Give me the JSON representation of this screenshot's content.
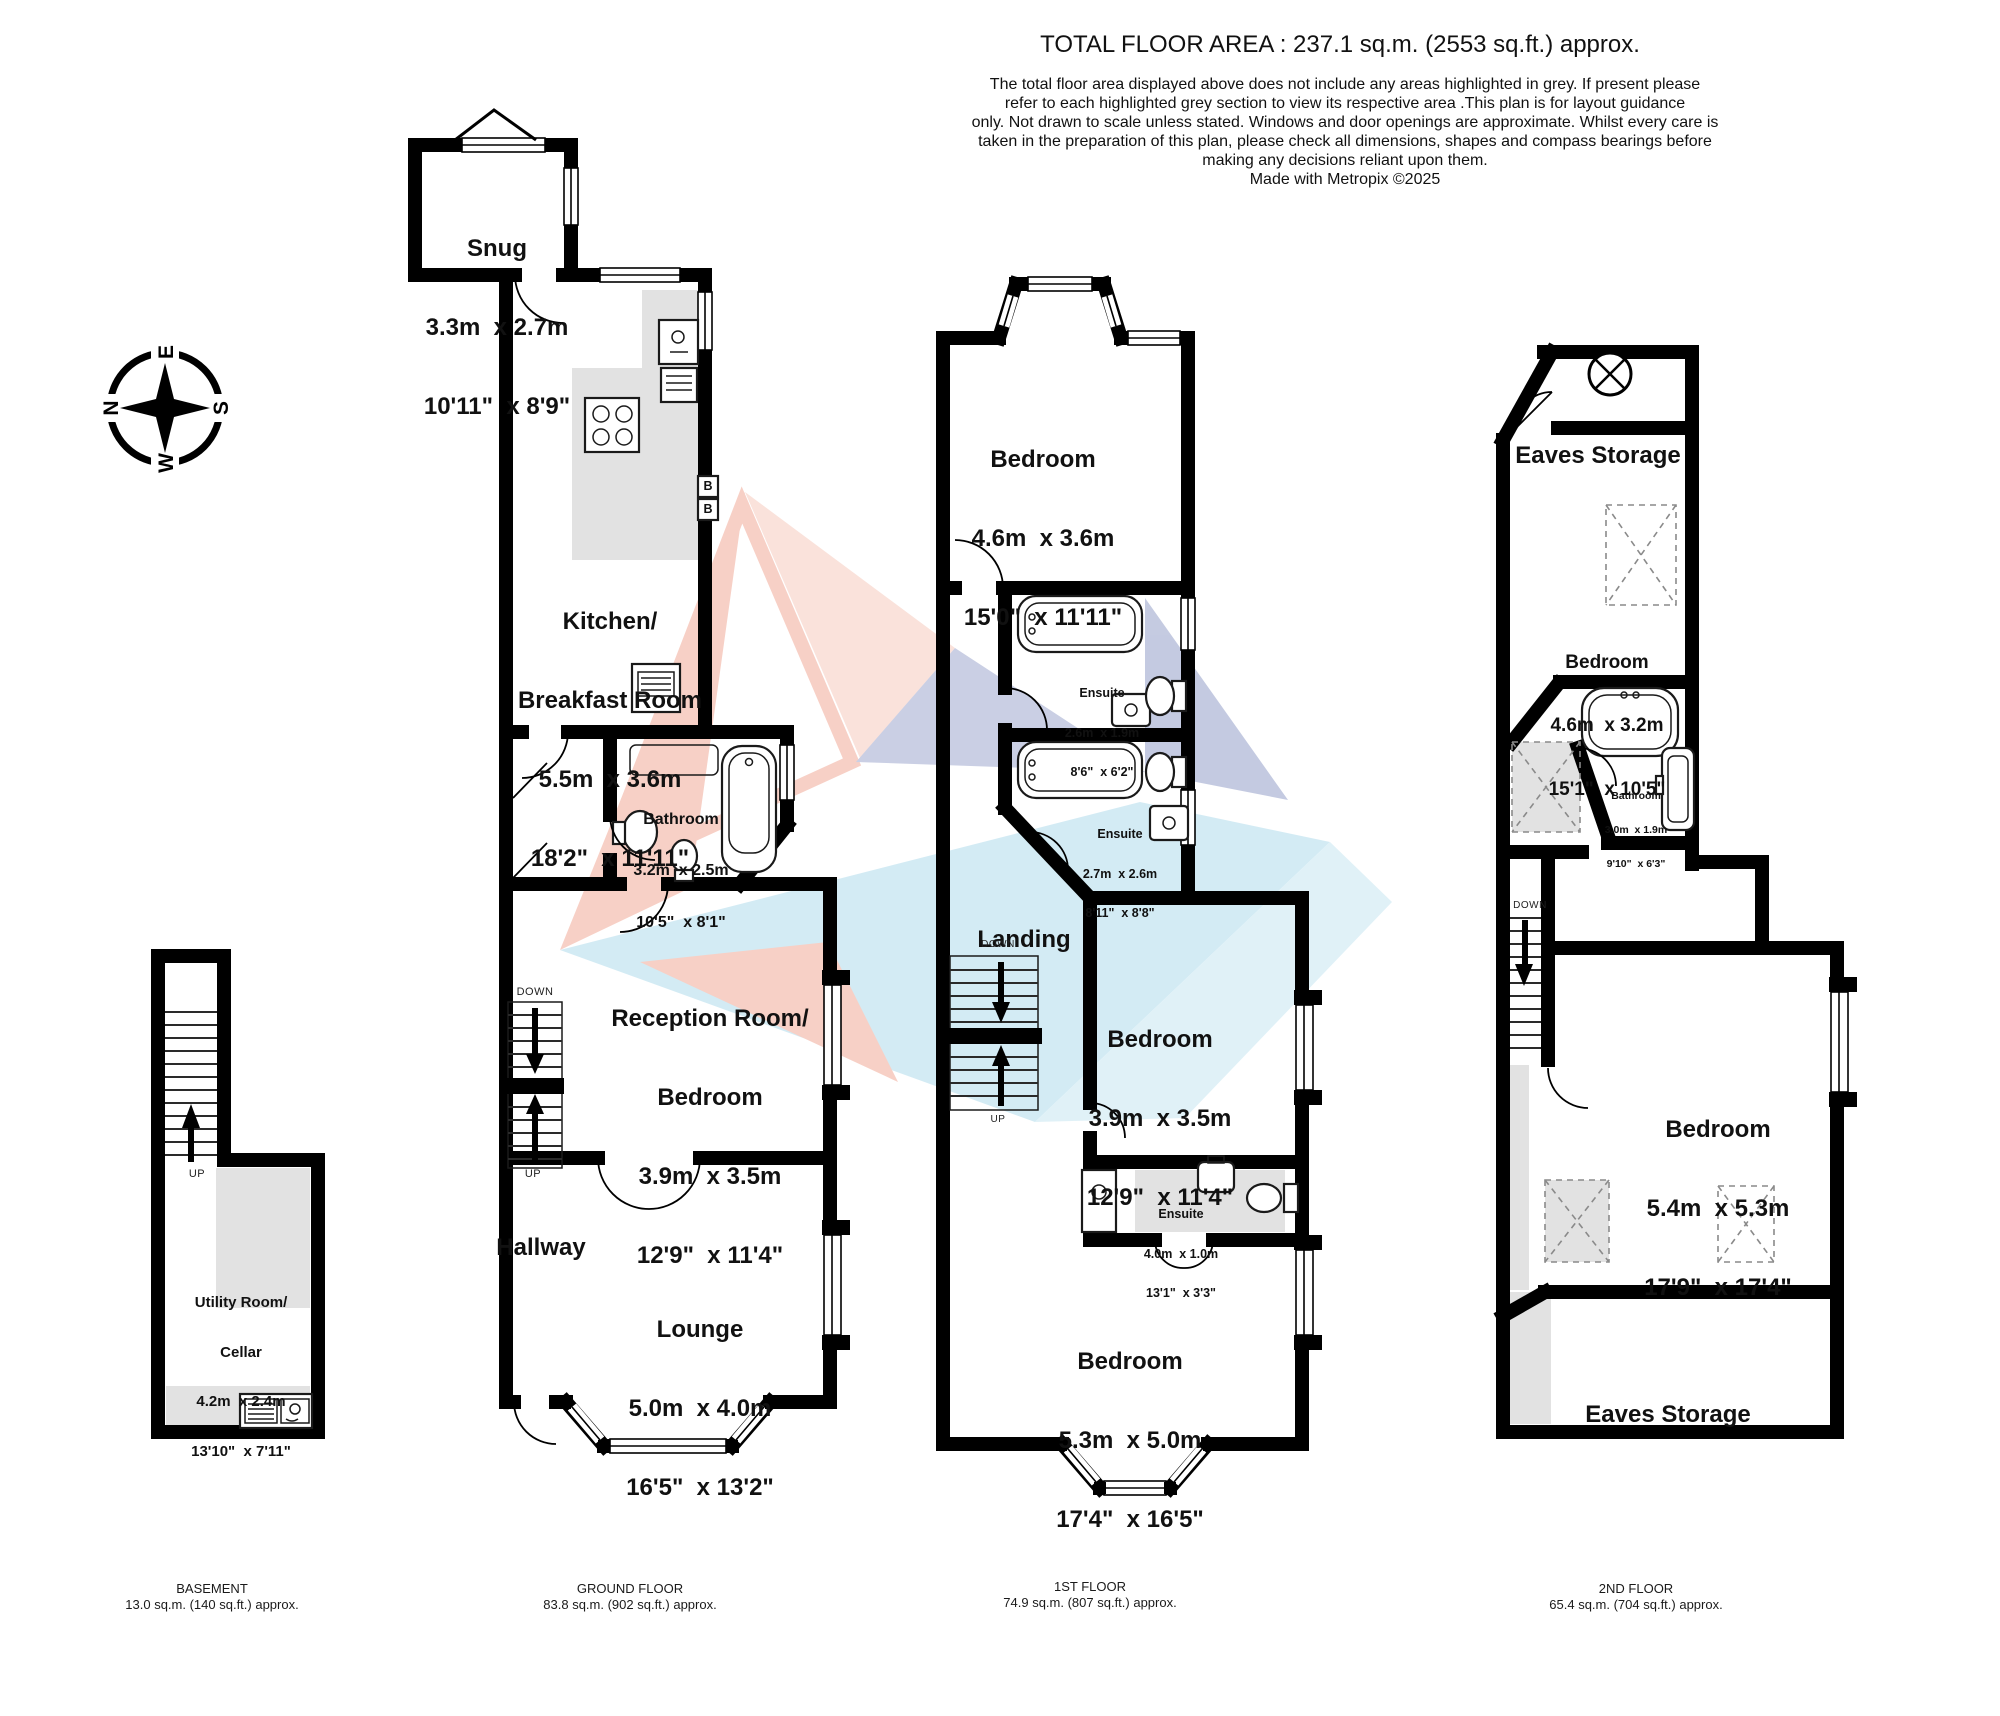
{
  "header": {
    "title": "TOTAL FLOOR AREA : 237.1 sq.m. (2553 sq.ft.) approx.",
    "disclaimer_lines": [
      "The total floor area displayed above does not include any areas highlighted in grey. If present please",
      "refer to each highlighted grey section to view its respective area .This plan is for layout guidance",
      "only. Not drawn to scale unless stated. Windows and door openings are approximate. Whilst every care is",
      "taken in the preparation of this plan, please check all dimensions, shapes and compass bearings before",
      "making any decisions reliant upon them.",
      "Made with Metropix ©2025"
    ]
  },
  "compass": {
    "n": "N",
    "e": "E",
    "s": "S",
    "w": "W"
  },
  "watermark_colors": {
    "pink": "#F0A28E",
    "blue": "#A9D8EA",
    "periwinkle": "#96A0CA"
  },
  "floors": {
    "basement": {
      "caption": "BASEMENT",
      "area": "13.0 sq.m. (140 sq.ft.) approx.",
      "labels": {
        "up": "UP"
      },
      "rooms": {
        "utility": {
          "name": "Utility Room/",
          "name2": "Cellar",
          "metric": "4.2m  x 2.4m",
          "imperial": "13'10\"  x 7'11\""
        }
      }
    },
    "ground": {
      "caption": "GROUND FLOOR",
      "area": "83.8 sq.m. (902 sq.ft.) approx.",
      "labels": {
        "up": "UP",
        "down": "DOWN",
        "boiler": "B"
      },
      "rooms": {
        "snug": {
          "name": "Snug",
          "metric": "3.3m  x 2.7m",
          "imperial": "10'11\"  x 8'9\""
        },
        "kitchen": {
          "name": "Kitchen/",
          "name2": "Breakfast Room",
          "metric": "5.5m  x 3.6m",
          "imperial": "18'2\"  x 11'11\""
        },
        "bathroom": {
          "name": "Bathroom",
          "metric": "3.2m  x 2.5m",
          "imperial": "10'5\"  x 8'1\""
        },
        "reception": {
          "name": "Reception Room/",
          "name2": "Bedroom",
          "metric": "3.9m  x 3.5m",
          "imperial": "12'9\"  x 11'4\""
        },
        "hallway": {
          "name": "Hallway"
        },
        "lounge": {
          "name": "Lounge",
          "metric": "5.0m  x 4.0m",
          "imperial": "16'5\"  x 13'2\""
        }
      }
    },
    "first": {
      "caption": "1ST FLOOR",
      "area": "74.9 sq.m. (807 sq.ft.) approx.",
      "labels": {
        "up": "UP",
        "down": "DOWN"
      },
      "rooms": {
        "bedroom_front": {
          "name": "Bedroom",
          "metric": "4.6m  x 3.6m",
          "imperial": "15'0\"  x 11'11\""
        },
        "ensuite1": {
          "name": "Ensuite",
          "metric": "2.6m  x 1.9m",
          "imperial": "8'6\"  x 6'2\""
        },
        "ensuite2": {
          "name": "Ensuite",
          "metric": "2.7m  x 2.6m",
          "imperial": "8'11\"  x 8'8\""
        },
        "landing": {
          "name": "Landing"
        },
        "bedroom_mid": {
          "name": "Bedroom",
          "metric": "3.9m  x 3.5m",
          "imperial": "12'9\"  x 11'4\""
        },
        "ensuite3": {
          "name": "Ensuite",
          "metric": "4.0m  x 1.0m",
          "imperial": "13'1\"  x 3'3\""
        },
        "bedroom_rear": {
          "name": "Bedroom",
          "metric": "5.3m  x 5.0m",
          "imperial": "17'4\"  x 16'5\""
        }
      }
    },
    "second": {
      "caption": "2ND FLOOR",
      "area": "65.4 sq.m. (704 sq.ft.) approx.",
      "labels": {
        "down": "DOWN"
      },
      "rooms": {
        "eaves_front": {
          "name": "Eaves Storage"
        },
        "bedroom_front": {
          "name": "Bedroom",
          "metric": "4.6m  x 3.2m",
          "imperial": "15'1\"  x 10'5\""
        },
        "bathroom": {
          "name": "Bathroom",
          "metric": "3.0m  x 1.9m",
          "imperial": "9'10\"  x 6'3\""
        },
        "bedroom_rear": {
          "name": "Bedroom",
          "metric": "5.4m  x 5.3m",
          "imperial": "17'9\"  x 17'4\""
        },
        "eaves_rear": {
          "name": "Eaves Storage"
        }
      }
    }
  }
}
